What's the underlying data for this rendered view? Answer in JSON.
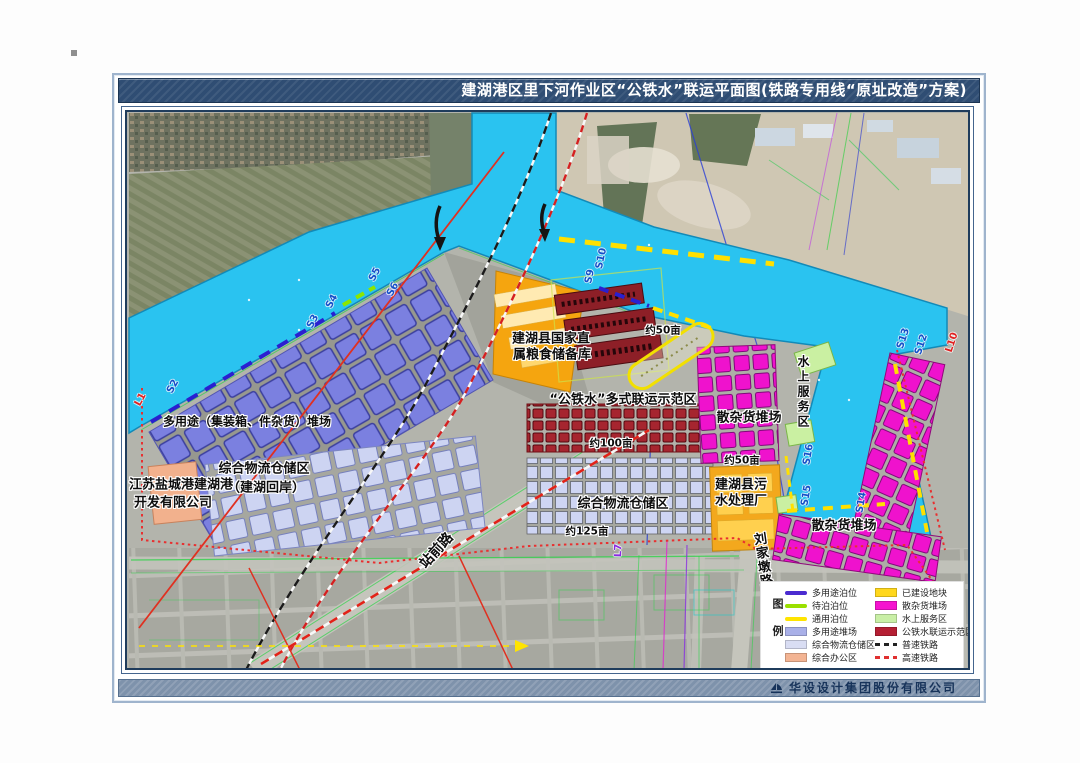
{
  "title": "建湖港区里下河作业区“公铁水”联运平面图(铁路专用线“原址改造”方案)",
  "footer": {
    "company": "华设设计集团股份有限公司"
  },
  "legend": {
    "title": "图例",
    "left": [
      {
        "label": "多用途泊位",
        "swatch": "line",
        "color": "#4b2bd0"
      },
      {
        "label": "待泊泊位",
        "swatch": "line",
        "color": "#9ae000"
      },
      {
        "label": "通用泊位",
        "swatch": "line",
        "color": "#ffe400"
      },
      {
        "label": "多用途堆场",
        "swatch": "box",
        "color": "#a9b0e8"
      },
      {
        "label": "综合物流仓储区",
        "swatch": "box",
        "color": "#d9ddf3"
      },
      {
        "label": "综合办公区",
        "swatch": "box",
        "color": "#f3b493"
      }
    ],
    "right": [
      {
        "label": "已建设地块",
        "swatch": "box",
        "color": "#ffd71c"
      },
      {
        "label": "散杂货堆场",
        "swatch": "box",
        "color": "#f513cf"
      },
      {
        "label": "水上服务区",
        "swatch": "box",
        "color": "#c9efa6"
      },
      {
        "label": "公铁水联运示范区",
        "swatch": "box",
        "color": "#b51f33"
      },
      {
        "label": "普速铁路",
        "swatch": "dash",
        "color": "#222222"
      },
      {
        "label": "高速铁路",
        "swatch": "dash",
        "color": "#e03030"
      }
    ]
  },
  "map": {
    "areas": {
      "multi_use": "多用途（集装箱、件杂货）堆场",
      "logistics_huian_line1": "综合物流仓储区",
      "logistics_huian_line2": "（建湖回岸）",
      "port_company_line1": "江苏盐城港建湖港",
      "port_company_line2": "开发有限公司",
      "grain_line1": "建湖县国家直",
      "grain_line2": "属粮食储备库",
      "demo_zone": "“公铁水”多式联运示范区",
      "logistics_center": "综合物流仓储区",
      "bulk_yard_upper": "散杂货堆场",
      "sewage_line1": "建湖县污",
      "sewage_line2": "水处理厂",
      "water_service": "水上服务区",
      "bulk_yard_lower": "散杂货堆场"
    },
    "roads": {
      "zhanqian": "站前路",
      "liujiadun": "刘家墩路"
    },
    "measures": {
      "mu50_top": "约50亩",
      "mu100": "约100亩",
      "mu125": "约125亩",
      "mu50_right": "约50亩"
    },
    "berths": {
      "s2": "S2",
      "s3": "S3",
      "s4": "S4",
      "s5": "S5",
      "s6": "S6",
      "s9": "S9",
      "s10": "S10",
      "s12": "S12",
      "s13": "S13",
      "s14": "S14",
      "s15": "S15",
      "s16": "S16",
      "l1": "L1",
      "l7": "L7",
      "l10": "L10"
    }
  }
}
